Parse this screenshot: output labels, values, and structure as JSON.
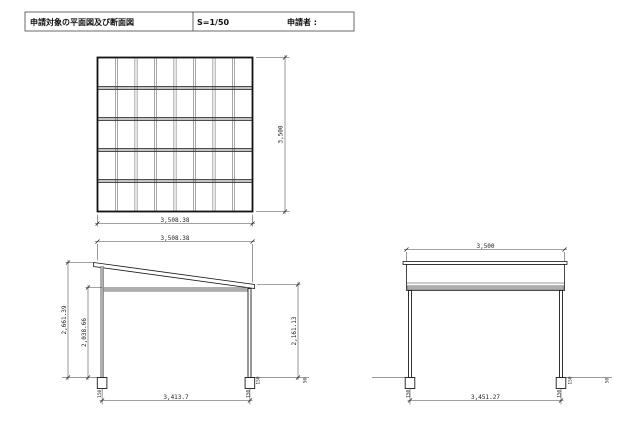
{
  "title_block": {
    "drawing_title": "申請対象の平面図及び断面図",
    "scale": "S=1/50",
    "applicant_label": "申請者 :"
  },
  "plan_view": {
    "width_dim": "3,508.38",
    "height_dim": "3,500"
  },
  "side_section": {
    "top_width_dim": "3,508.38",
    "overall_height_dim": "2,661.39",
    "eave_height_dim": "2,038.66",
    "low_side_height_dim": "2,161.13",
    "post_span_dim": "3,413.7",
    "left_footing_dim": "150",
    "right_footing_dim": "150",
    "ground_step_dim": "150",
    "ground_offset_dim": "50"
  },
  "front_section": {
    "top_width_dim": "3,500",
    "post_span_dim": "3,451.27",
    "left_footing_dim": "150",
    "right_footing_dim": "150",
    "ground_step_dim": "150",
    "ground_offset_dim": "50"
  }
}
